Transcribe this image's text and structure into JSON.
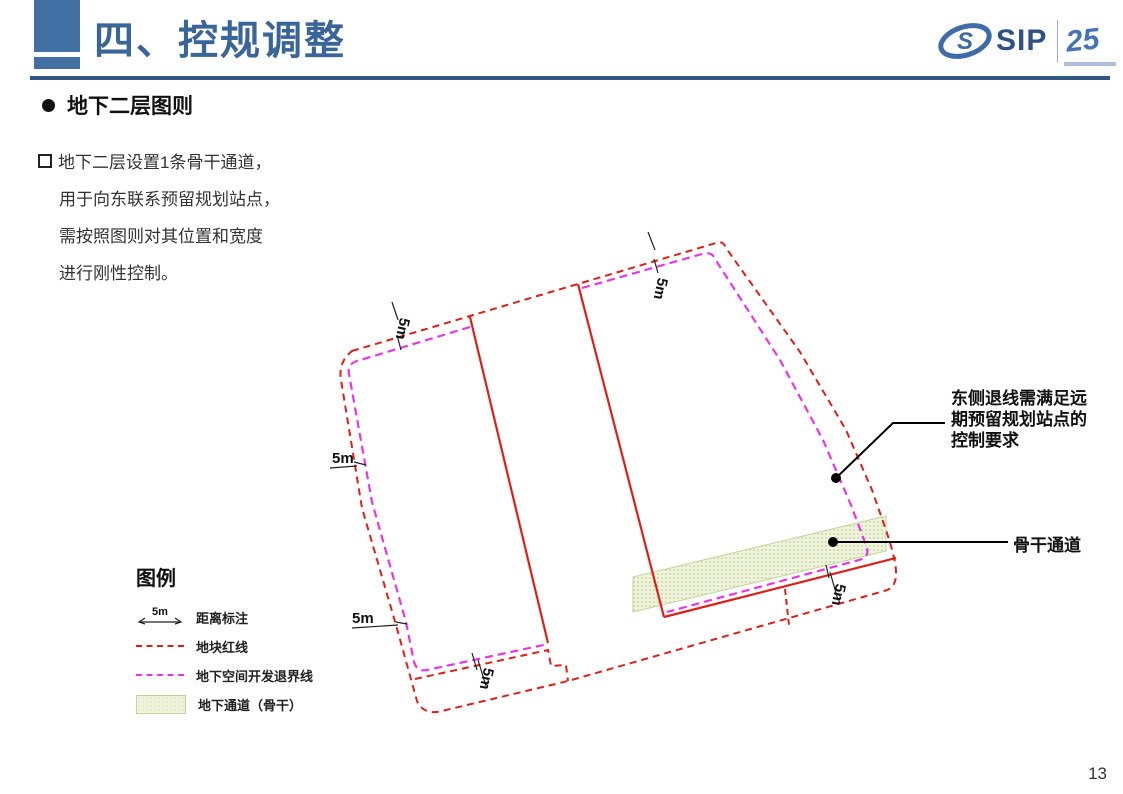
{
  "header": {
    "title": "四、控规调整",
    "logo": {
      "brand": "SIP",
      "anniversary": "25"
    }
  },
  "section": {
    "heading": "地下二层图则",
    "body_lines": [
      "地下二层设置1条骨干通道，",
      "用于向东联系预留规划站点，",
      "需按照图则对其位置和宽度",
      "进行刚性控制。"
    ]
  },
  "diagram": {
    "dim_labels": [
      "5m",
      "5m",
      "5m",
      "5m",
      "5m",
      "5m"
    ],
    "callout_east": {
      "lines": [
        "东侧退线需满足远",
        "期预留规划站点的",
        "控制要求"
      ]
    },
    "callout_channel": {
      "label": "骨干通道"
    },
    "colors": {
      "plot_red": "#DD2017",
      "setback_magenta": "#E935E9",
      "channel_fill": "#F0F4DC",
      "channel_dot": "#BCCF96",
      "channel_border": "#C2D39B"
    }
  },
  "legend": {
    "title": "图例",
    "dim_symbol": "5m",
    "items": [
      {
        "label": "距离标注"
      },
      {
        "label": "地块红线"
      },
      {
        "label": "地下空间开发退界线"
      },
      {
        "label": "地下通道（骨干）"
      }
    ]
  },
  "footer": {
    "page_number": "13"
  }
}
